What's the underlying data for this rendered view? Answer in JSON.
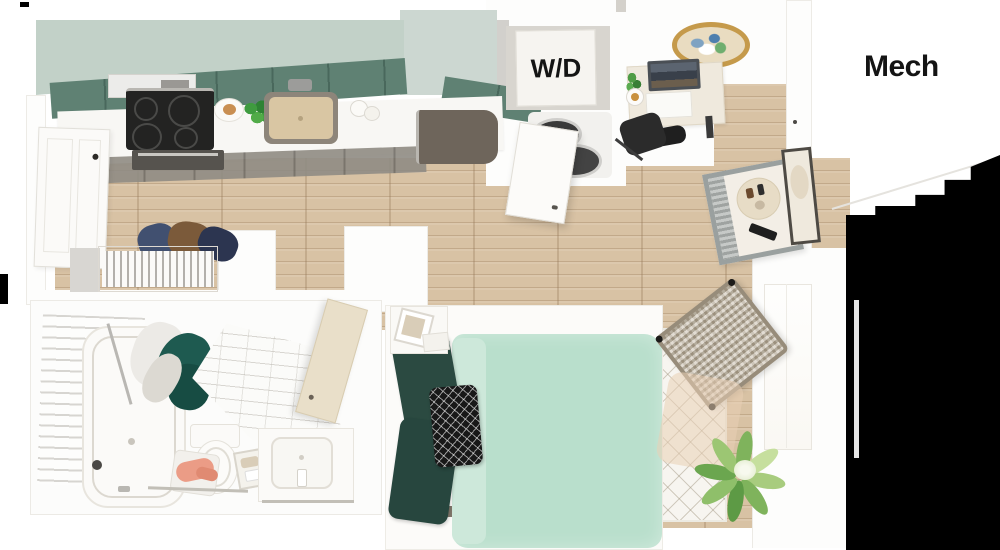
{
  "labels": {
    "washer_dryer": "W/D",
    "mechanical_room": "Mech"
  },
  "palette": {
    "label_color": "#141414",
    "cabinet_sage": "#c2d1c8",
    "cabinet_tall_sage": "#ccd7d1",
    "cabinet_teal": "#5f8173",
    "base_cabinet": "#908c84",
    "counter_white": "#f8f7f4",
    "floor_wood": "#d8c2a4",
    "duvet_mint": "#b9dfcc",
    "pillow_green": "#2b4a41",
    "accent_pillow_black": "#181818",
    "shower_curtain_teal": "#1e5a50",
    "gold_tray": "#c59a4b",
    "appliance_dark": "#6e655b",
    "stove_black": "#232322",
    "towel_pink": "#eb9c86",
    "plant_green": "#7fb35c",
    "artifact_black": "#000000"
  }
}
